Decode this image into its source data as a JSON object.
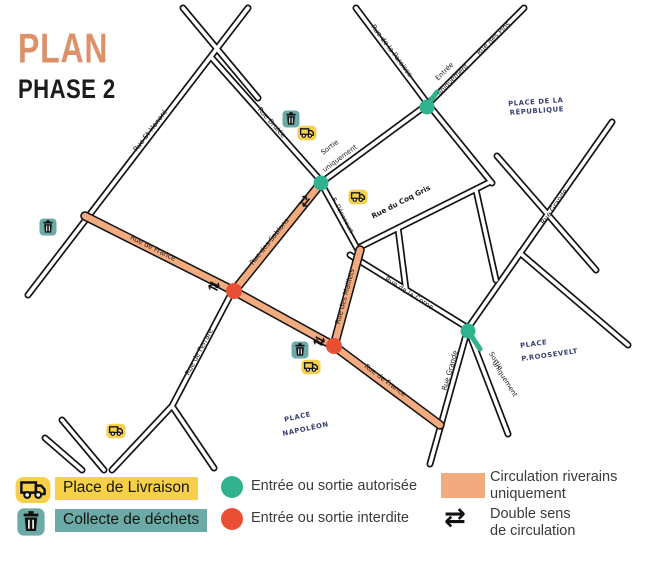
{
  "title": {
    "line1": "PLAN",
    "line2": "PHASE 2"
  },
  "colors": {
    "salmon": "#dc9169",
    "orange": "#f2ab7e",
    "teal": "#2fb28d",
    "tealmuted": "#6caaa7",
    "red": "#e94f35",
    "yellow": "#f6d04b",
    "navy": "#333d6e"
  },
  "icons": {
    "truck_icon": "delivery-truck",
    "trash_icon": "trash-bin",
    "double_sens_glyph": "⇄"
  },
  "map": {
    "streets": {
      "st_honore": "Rue St-Honoré",
      "brulee": "Rue Brulée",
      "paroisse": "Rue de la Paroisse",
      "pins": "Rue des Pins",
      "coq_gris": "Rue du Coq Gris",
      "denecourt": "R. Dénecourt",
      "corne": "Rue de la Corne",
      "grande": "Rue Grande",
      "france": "Rue de France",
      "sablons": "Rue des Sablons",
      "maillets": "Rue des Maillets",
      "ferrare": "Rue de Ferrare"
    },
    "notes": {
      "sortie_top": [
        "Sortie",
        "uniquement"
      ],
      "entree": [
        "Entrée",
        "uniquement"
      ],
      "sortie_bottom": [
        "Sortie",
        "uniquement"
      ]
    },
    "places": {
      "republique": [
        "PLACE DE LA",
        "RÉPUBLIQUE"
      ],
      "roosevelt": [
        "PLACE",
        "P.ROOSEVELT"
      ],
      "napoleon": [
        "PLACE",
        "NAPOLÉON"
      ]
    }
  },
  "legend": {
    "place_livraison": "Place de Livraison",
    "collecte_dechets": "Collecte de déchets",
    "entree_autorisee": "Entrée ou sortie autorisée",
    "entree_interdite": "Entrée ou sortie interdite",
    "circulation_riverains": [
      "Circulation riverains",
      "uniquement"
    ],
    "double_sens": [
      "Double sens",
      "de circulation"
    ]
  }
}
